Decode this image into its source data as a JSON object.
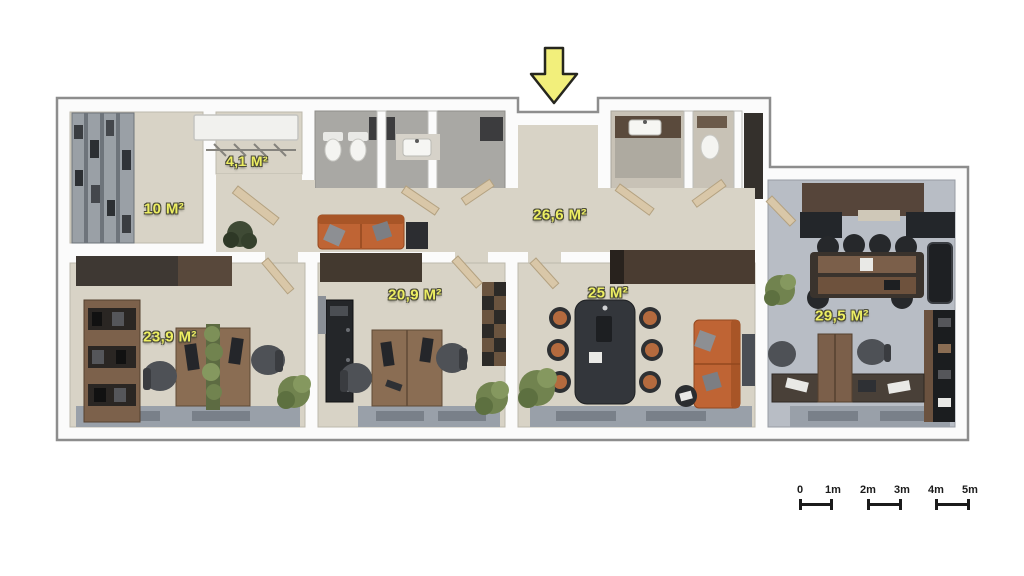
{
  "plan": {
    "type": "3d-office-floor-plan",
    "entrance_marker": "down-arrow",
    "rooms": [
      {
        "name": "storage-room",
        "area_label": "10 M²"
      },
      {
        "name": "wardrobe-room",
        "area_label": "4,1 M²"
      },
      {
        "name": "hallway",
        "area_label": "26,6 M²"
      },
      {
        "name": "office-left",
        "area_label": "23,9 M²"
      },
      {
        "name": "office-middle",
        "area_label": "20,9 M²"
      },
      {
        "name": "meeting-room",
        "area_label": "25 M²"
      },
      {
        "name": "office-right",
        "area_label": "29,5 M²"
      }
    ]
  },
  "scale_bar": {
    "labels": [
      "0",
      "1m",
      "2m",
      "3m",
      "4m",
      "5m"
    ]
  },
  "colors": {
    "label_yellow": "#edee62",
    "arrow_yellow": "#f2ef7b",
    "scale_black": "#1b1b1b",
    "wall_white": "#fbfbfb",
    "wall_edge": "#8d8d8d",
    "floor_beige": "#d8d3c6",
    "floor_gray_blue": "#b8bdc5",
    "tile_gray": "#a9a8a4",
    "tile_warm": "#c8c2b6",
    "wood_dark": "#453a31",
    "wood_mid": "#8a6d53",
    "sofa_orange": "#bf6434",
    "door_tan": "#d9c7a8",
    "plant_green": "#71834f",
    "window_sill_gray": "#99a0a9"
  }
}
